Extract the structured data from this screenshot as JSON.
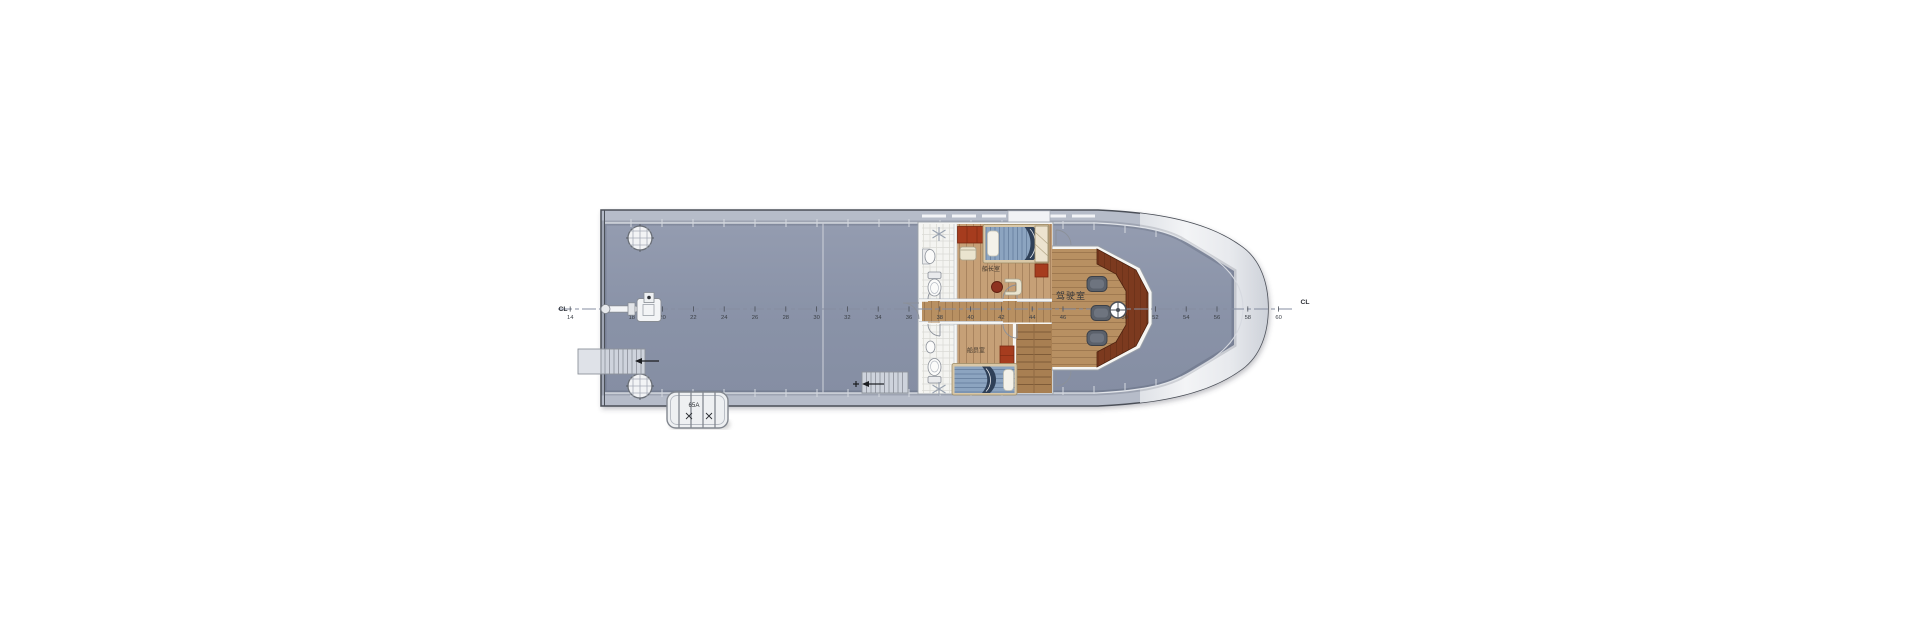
{
  "plan": {
    "centerline": {
      "left_label": "CL",
      "right_label": "CL"
    },
    "stations": {
      "start_x": 601,
      "base_frame": 16,
      "spacing_per_frame": 15.4,
      "y": 309,
      "tick_min": 14,
      "tick_max": 60,
      "labels": [
        14,
        18,
        20,
        22,
        24,
        26,
        28,
        30,
        32,
        34,
        36,
        38,
        40,
        42,
        44,
        46,
        50,
        52,
        54,
        56,
        58,
        60
      ]
    },
    "rooms": {
      "wheelhouse": "驾驶室",
      "captain_cabin": "船长室",
      "crew_cabin": "船员室"
    },
    "liferaft_label": "65A",
    "colors": {
      "deck": "#8a93a8",
      "bulwark": "#b6bcc9",
      "hull_outline": "#4b5058",
      "bow_light": "#eef0f3",
      "corridor_wood": "#b89062",
      "cabin_wood": "#c6a077",
      "stair_wood": "#a87f52",
      "console_wood": "#7c3a1f",
      "cabinet_red": "#a63c1e",
      "bed_blue": "#8ca4c0",
      "blanket_navy": "#2f4058",
      "tile": "#f4f4f1",
      "chair_gray": "#5b616b",
      "equipment_white": "#f3f4f6"
    }
  }
}
